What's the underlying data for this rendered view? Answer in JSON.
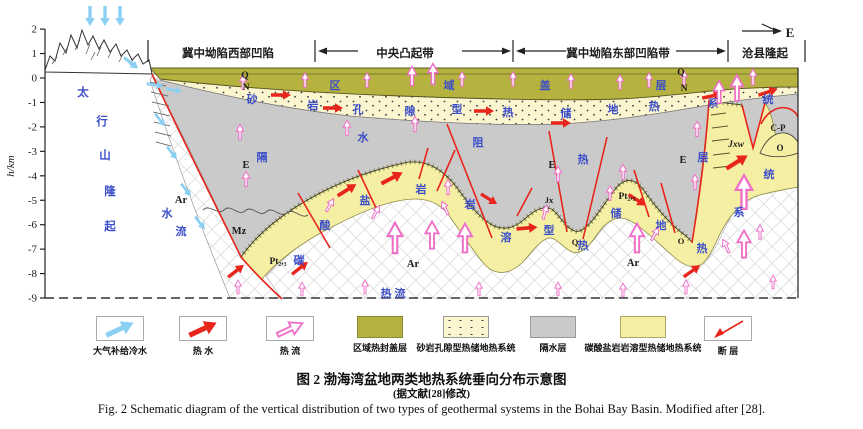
{
  "caption": {
    "cn": "图 2  渤海湾盆地两类地热系统垂向分布示意图",
    "note": "(据文献[28]修改)",
    "en": "Fig. 2   Schematic diagram of the vertical distribution of two types of geothermal systems in the Bohai Bay Basin.  Modified after [28]."
  },
  "axis": {
    "label": "h/km",
    "ticks": [
      2,
      1,
      0,
      -1,
      -2,
      -3,
      -4,
      -5,
      -6,
      -7,
      -8,
      -9
    ]
  },
  "colors": {
    "blue_text": "#3c4ec8",
    "black_text": "#1c1c1c",
    "fault_red": "#e8251d",
    "hot_arrow": "#e8251d",
    "cold_arrow": "#8bd0f2",
    "heat_arrow_outline": "#ef6fc8",
    "cap_olive": "#b5b240",
    "sandstone_cream": "#fbf5d0",
    "aquitard_gray": "#cacaca",
    "carbonate_yellow": "#f5efa3"
  },
  "legend": {
    "items": [
      {
        "label": "大气补给冷水",
        "swatch": "cold-arrow"
      },
      {
        "label": "热  水",
        "swatch": "hot-arrow"
      },
      {
        "label": "热  流",
        "swatch": "heat-arrow"
      },
      {
        "label": "区域热封盖层",
        "swatch": "olive"
      },
      {
        "label": "砂岩孔隙型热储地热系统",
        "swatch": "dotted"
      },
      {
        "label": "隔水层",
        "swatch": "gray"
      },
      {
        "label": "碳酸盐岩岩溶型热储地热系统",
        "swatch": "yellow"
      },
      {
        "label": "断  层",
        "swatch": "fault"
      }
    ]
  },
  "labels": [
    {
      "g": "header",
      "t": "冀中坳陷西部凹陷",
      "x": 228,
      "y": 57,
      "c": "k",
      "s": 11.5,
      "w": 700
    },
    {
      "g": "header",
      "t": "中央凸起带",
      "x": 405,
      "y": 57,
      "c": "k",
      "s": 11.5,
      "w": 700
    },
    {
      "g": "header",
      "t": "冀中坳陷东部凹陷带",
      "x": 618,
      "y": 57,
      "c": "k",
      "s": 11.5,
      "w": 700
    },
    {
      "g": "header",
      "t": "沧县隆起",
      "x": 765,
      "y": 57,
      "c": "k",
      "s": 11.5,
      "w": 700
    },
    {
      "g": "header",
      "t": "E",
      "x": 790,
      "y": 37,
      "c": "k",
      "s": 13,
      "w": 700,
      "f": "serif"
    },
    {
      "g": "cap-layer",
      "t": "区",
      "x": 335,
      "y": 89,
      "c": "b",
      "s": 11,
      "w": 700
    },
    {
      "g": "cap-layer",
      "t": "域",
      "x": 449,
      "y": 89,
      "c": "b",
      "s": 11,
      "w": 700
    },
    {
      "g": "cap-layer",
      "t": "盖",
      "x": 545,
      "y": 89,
      "c": "b",
      "s": 11,
      "w": 700
    },
    {
      "g": "cap-layer",
      "t": "层",
      "x": 661,
      "y": 89,
      "c": "b",
      "s": 11,
      "w": 700
    },
    {
      "g": "strat",
      "t": "Q",
      "x": 245,
      "y": 78,
      "c": "k",
      "s": 9.5,
      "w": 700,
      "f": "serif"
    },
    {
      "g": "strat",
      "t": "N",
      "x": 246,
      "y": 90,
      "c": "k",
      "s": 9.5,
      "w": 700,
      "f": "serif"
    },
    {
      "g": "strat",
      "t": "Q",
      "x": 681,
      "y": 75,
      "c": "k",
      "s": 9.5,
      "w": 700,
      "f": "serif"
    },
    {
      "g": "strat",
      "t": "N",
      "x": 684,
      "y": 91,
      "c": "k",
      "s": 9.5,
      "w": 700,
      "f": "serif"
    },
    {
      "g": "sandstone",
      "t": "砂",
      "x": 252,
      "y": 103,
      "c": "b",
      "s": 11,
      "w": 700
    },
    {
      "g": "sandstone",
      "t": "岩",
      "x": 313,
      "y": 109,
      "c": "b",
      "s": 11,
      "w": 700
    },
    {
      "g": "sandstone",
      "t": "孔",
      "x": 358,
      "y": 113,
      "c": "b",
      "s": 11,
      "w": 700
    },
    {
      "g": "sandstone",
      "t": "隙",
      "x": 410,
      "y": 115,
      "c": "b",
      "s": 11,
      "w": 700
    },
    {
      "g": "sandstone",
      "t": "型",
      "x": 457,
      "y": 113,
      "c": "b",
      "s": 11,
      "w": 700
    },
    {
      "g": "sandstone",
      "t": "热",
      "x": 508,
      "y": 116,
      "c": "b",
      "s": 11,
      "w": 700
    },
    {
      "g": "sandstone",
      "t": "储",
      "x": 566,
      "y": 117,
      "c": "b",
      "s": 11,
      "w": 700
    },
    {
      "g": "sandstone",
      "t": "地",
      "x": 613,
      "y": 113,
      "c": "b",
      "s": 11,
      "w": 700
    },
    {
      "g": "sandstone",
      "t": "热",
      "x": 654,
      "y": 110,
      "c": "b",
      "s": 11,
      "w": 700
    },
    {
      "g": "sandstone",
      "t": "系",
      "x": 713,
      "y": 107,
      "c": "b",
      "s": 11,
      "w": 700
    },
    {
      "g": "sandstone",
      "t": "统",
      "x": 768,
      "y": 103,
      "c": "b",
      "s": 11,
      "w": 700
    },
    {
      "g": "aquitard",
      "t": "隔",
      "x": 262,
      "y": 161,
      "c": "b",
      "s": 11,
      "w": 700
    },
    {
      "g": "aquitard",
      "t": "水",
      "x": 363,
      "y": 141,
      "c": "b",
      "s": 11,
      "w": 700
    },
    {
      "g": "aquitard",
      "t": "阻",
      "x": 478,
      "y": 146,
      "c": "b",
      "s": 11,
      "w": 700
    },
    {
      "g": "aquitard",
      "t": "热",
      "x": 583,
      "y": 163,
      "c": "b",
      "s": 11,
      "w": 700
    },
    {
      "g": "aquitard",
      "t": "层",
      "x": 703,
      "y": 161,
      "c": "b",
      "s": 11,
      "w": 700
    },
    {
      "g": "strat",
      "t": "E",
      "x": 246,
      "y": 168,
      "c": "k",
      "s": 10.5,
      "w": 700,
      "f": "serif"
    },
    {
      "g": "strat",
      "t": "E",
      "x": 552,
      "y": 168,
      "c": "k",
      "s": 10.5,
      "w": 700,
      "f": "serif"
    },
    {
      "g": "strat",
      "t": "E",
      "x": 683,
      "y": 163,
      "c": "k",
      "s": 10.5,
      "w": 700,
      "f": "serif"
    },
    {
      "g": "strat",
      "t": "Mz",
      "x": 239,
      "y": 234,
      "c": "k",
      "s": 10.5,
      "w": 700,
      "f": "serif"
    },
    {
      "g": "carbonate",
      "t": "碳",
      "x": 299,
      "y": 264,
      "c": "b",
      "s": 11,
      "w": 700
    },
    {
      "g": "carbonate",
      "t": "酸",
      "x": 325,
      "y": 229,
      "c": "b",
      "s": 11,
      "w": 700
    },
    {
      "g": "carbonate",
      "t": "盐",
      "x": 365,
      "y": 204,
      "c": "b",
      "s": 11,
      "w": 700
    },
    {
      "g": "carbonate",
      "t": "岩",
      "x": 421,
      "y": 193,
      "c": "b",
      "s": 11,
      "w": 700
    },
    {
      "g": "carbonate",
      "t": "岩",
      "x": 470,
      "y": 208,
      "c": "b",
      "s": 11,
      "w": 700
    },
    {
      "g": "carbonate",
      "t": "溶",
      "x": 506,
      "y": 241,
      "c": "b",
      "s": 11,
      "w": 700
    },
    {
      "g": "carbonate",
      "t": "型",
      "x": 549,
      "y": 234,
      "c": "b",
      "s": 11,
      "w": 700
    },
    {
      "g": "carbonate",
      "t": "热",
      "x": 583,
      "y": 249,
      "c": "b",
      "s": 11,
      "w": 700
    },
    {
      "g": "carbonate",
      "t": "储",
      "x": 616,
      "y": 217,
      "c": "b",
      "s": 11,
      "w": 700
    },
    {
      "g": "carbonate",
      "t": "地",
      "x": 661,
      "y": 229,
      "c": "b",
      "s": 11,
      "w": 700
    },
    {
      "g": "carbonate",
      "t": "热",
      "x": 702,
      "y": 252,
      "c": "b",
      "s": 11,
      "w": 700
    },
    {
      "g": "carbonate",
      "t": "系",
      "x": 739,
      "y": 216,
      "c": "b",
      "s": 11,
      "w": 700
    },
    {
      "g": "carbonate",
      "t": "统",
      "x": 769,
      "y": 178,
      "c": "b",
      "s": 11,
      "w": 700
    },
    {
      "g": "strat",
      "t": "Pt₂,₃",
      "x": 278,
      "y": 264,
      "c": "k",
      "s": 9.5,
      "w": 700,
      "f": "serif"
    },
    {
      "g": "strat",
      "t": "Pt₂,₃",
      "x": 627,
      "y": 199,
      "c": "k",
      "s": 9.5,
      "w": 700,
      "f": "serif"
    },
    {
      "g": "strat",
      "t": "Jx",
      "x": 549,
      "y": 203,
      "c": "k",
      "s": 8.5,
      "w": 700,
      "f": "serif"
    },
    {
      "g": "strat",
      "t": "Q",
      "x": 575,
      "y": 245,
      "c": "k",
      "s": 8.5,
      "w": 700,
      "f": "serif"
    },
    {
      "g": "strat",
      "t": "O",
      "x": 681,
      "y": 244,
      "c": "k",
      "s": 8.5,
      "w": 700,
      "f": "serif"
    },
    {
      "g": "strat",
      "t": "Jxw",
      "x": 736,
      "y": 147,
      "c": "k",
      "s": 9.5,
      "w": 700,
      "f": "serif",
      "i": 1
    },
    {
      "g": "strat",
      "t": "C-P",
      "x": 778,
      "y": 131,
      "c": "k",
      "s": 9,
      "w": 700,
      "f": "serif"
    },
    {
      "g": "strat",
      "t": "O",
      "x": 780,
      "y": 151,
      "c": "k",
      "s": 9,
      "w": 700,
      "f": "serif"
    },
    {
      "g": "strat",
      "t": "Ar",
      "x": 181,
      "y": 203,
      "c": "k",
      "s": 10.5,
      "w": 700,
      "f": "serif"
    },
    {
      "g": "strat",
      "t": "Ar",
      "x": 413,
      "y": 267,
      "c": "k",
      "s": 10.5,
      "w": 700,
      "f": "serif"
    },
    {
      "g": "strat",
      "t": "Ar",
      "x": 633,
      "y": 266,
      "c": "k",
      "s": 10.5,
      "w": 700,
      "f": "serif"
    },
    {
      "g": "basement",
      "t": "热 流",
      "x": 393,
      "y": 297,
      "c": "b",
      "s": 11,
      "w": 700
    },
    {
      "g": "mountain",
      "t": "太",
      "x": 83,
      "y": 96,
      "c": "b",
      "s": 11.5,
      "w": 700
    },
    {
      "g": "mountain",
      "t": "行",
      "x": 102,
      "y": 125,
      "c": "b",
      "s": 11.5,
      "w": 700
    },
    {
      "g": "mountain",
      "t": "山",
      "x": 105,
      "y": 159,
      "c": "b",
      "s": 11.5,
      "w": 700
    },
    {
      "g": "mountain",
      "t": "隆",
      "x": 110,
      "y": 195,
      "c": "b",
      "s": 11.5,
      "w": 700
    },
    {
      "g": "mountain",
      "t": "起",
      "x": 110,
      "y": 230,
      "c": "b",
      "s": 11.5,
      "w": 700
    },
    {
      "g": "west",
      "t": "水",
      "x": 167,
      "y": 217,
      "c": "b",
      "s": 11,
      "w": 700
    },
    {
      "g": "west",
      "t": "流",
      "x": 181,
      "y": 235,
      "c": "b",
      "s": 11,
      "w": 700
    }
  ],
  "arrows": {
    "hot": [
      [
        281,
        95,
        0,
        1
      ],
      [
        333,
        108,
        0,
        1
      ],
      [
        484,
        111,
        0,
        1
      ],
      [
        561,
        123,
        0,
        1
      ],
      [
        712,
        96,
        -12,
        1
      ],
      [
        768,
        92,
        -18,
        1
      ],
      [
        236,
        271,
        -38,
        1
      ],
      [
        300,
        268,
        -38,
        1
      ],
      [
        347,
        190,
        -32,
        1.1
      ],
      [
        392,
        178,
        -28,
        1.2
      ],
      [
        489,
        199,
        32,
        0.95
      ],
      [
        527,
        228,
        -5,
        1.05
      ],
      [
        637,
        200,
        33,
        1
      ],
      [
        692,
        271,
        -35,
        1
      ],
      [
        737,
        162,
        -32,
        1.25
      ]
    ],
    "cold": [
      [
        90,
        16,
        90,
        1
      ],
      [
        105,
        16,
        90,
        1
      ],
      [
        120,
        16,
        90,
        1
      ],
      [
        131,
        63,
        38,
        0.9
      ],
      [
        155,
        85,
        8,
        0.85
      ],
      [
        174,
        90,
        10,
        0.8
      ],
      [
        160,
        120,
        52,
        0.8
      ],
      [
        172,
        153,
        52,
        0.8
      ],
      [
        186,
        190,
        52,
        0.8
      ],
      [
        200,
        223,
        52,
        0.8
      ]
    ],
    "heat": [
      [
        243,
        82,
        -90,
        0.9
      ],
      [
        305,
        80,
        -90,
        0.9
      ],
      [
        367,
        80,
        -90,
        0.9
      ],
      [
        412,
        76,
        -90,
        1.2
      ],
      [
        433,
        74,
        -90,
        1.3
      ],
      [
        462,
        79,
        -90,
        0.9
      ],
      [
        513,
        79,
        -90,
        0.9
      ],
      [
        571,
        81,
        -90,
        0.9
      ],
      [
        620,
        82,
        -90,
        0.9
      ],
      [
        649,
        80,
        -90,
        0.9
      ],
      [
        684,
        78,
        -90,
        0.9
      ],
      [
        753,
        77,
        -90,
        1
      ],
      [
        240,
        132,
        -90,
        0.95
      ],
      [
        347,
        128,
        -90,
        0.95
      ],
      [
        415,
        124,
        -90,
        0.95
      ],
      [
        246,
        179,
        -90,
        0.95
      ],
      [
        448,
        187,
        -90,
        0.95
      ],
      [
        558,
        174,
        -90,
        0.95
      ],
      [
        623,
        172,
        -90,
        0.95
      ],
      [
        695,
        182,
        -90,
        0.95
      ],
      [
        697,
        129,
        -90,
        0.95
      ],
      [
        330,
        205,
        -60,
        0.9
      ],
      [
        376,
        212,
        -62,
        0.9
      ],
      [
        445,
        208,
        -115,
        0.9
      ],
      [
        545,
        212,
        -75,
        0.9
      ],
      [
        610,
        193,
        -90,
        0.9
      ],
      [
        655,
        234,
        -60,
        0.9
      ],
      [
        726,
        246,
        -115,
        0.9
      ],
      [
        760,
        232,
        -90,
        0.9
      ],
      [
        238,
        287,
        -90,
        0.85
      ],
      [
        302,
        289,
        -90,
        0.85
      ],
      [
        365,
        287,
        -90,
        0.85
      ],
      [
        479,
        289,
        -90,
        0.85
      ],
      [
        558,
        289,
        -90,
        0.85
      ],
      [
        623,
        290,
        -90,
        0.85
      ],
      [
        686,
        287,
        -90,
        0.85
      ],
      [
        773,
        282,
        -90,
        0.85
      ]
    ],
    "heat_big": [
      [
        395,
        238,
        -90,
        1.9
      ],
      [
        432,
        235,
        -90,
        1.7
      ],
      [
        465,
        238,
        -90,
        1.8
      ],
      [
        637,
        238,
        -90,
        1.8
      ],
      [
        744,
        192,
        -90,
        2.1
      ],
      [
        744,
        244,
        -90,
        1.7
      ],
      [
        719,
        92,
        -90,
        1.4
      ],
      [
        737,
        88,
        -90,
        1.6
      ]
    ]
  }
}
